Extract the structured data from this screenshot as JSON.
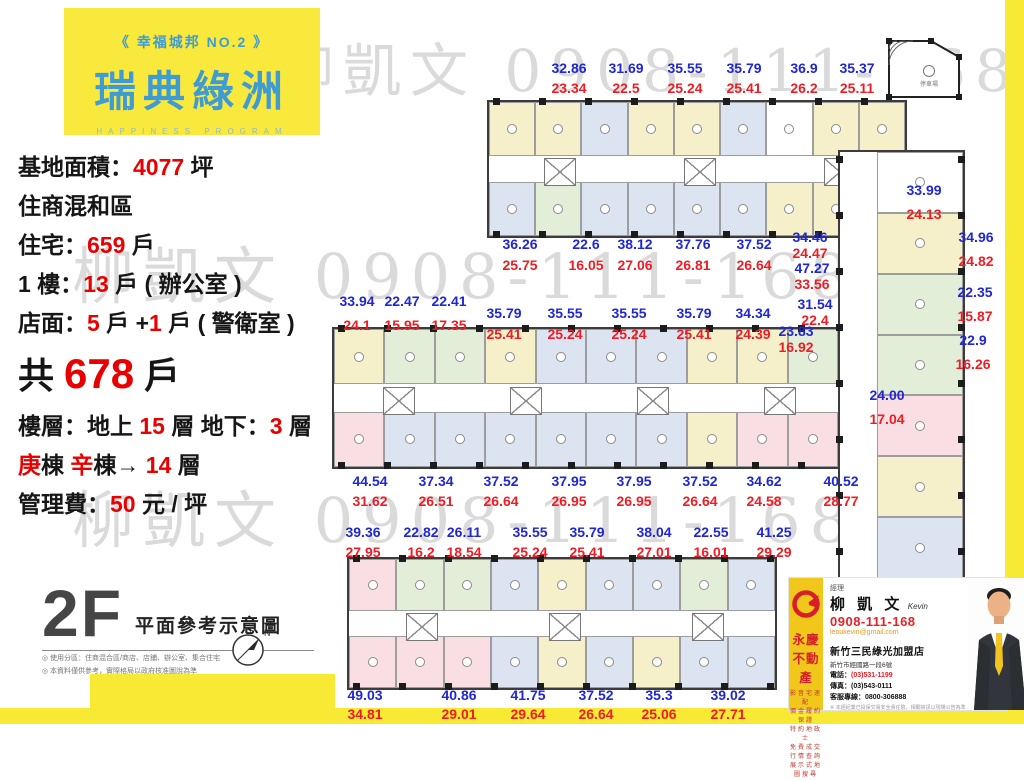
{
  "logo": {
    "tagline": "《 幸福城邦 NO.2 》",
    "title": "瑞典綠洲",
    "subtitle": "HAPPINESS PROGRAM"
  },
  "info": {
    "lines": [
      {
        "segs": [
          [
            "基地面積：",
            "k"
          ],
          [
            "4077",
            "r"
          ],
          [
            " 坪",
            "k"
          ]
        ]
      },
      {
        "segs": [
          [
            "住商混和區",
            "k"
          ]
        ]
      },
      {
        "segs": [
          [
            "住宅：",
            "k"
          ],
          [
            "659",
            "r"
          ],
          [
            " 戶",
            "k"
          ]
        ]
      },
      {
        "segs": [
          [
            "1 樓：",
            "k"
          ],
          [
            "13",
            "r"
          ],
          [
            " 戶 ( 辦公室 )",
            "k"
          ]
        ]
      },
      {
        "segs": [
          [
            "店面：",
            "k"
          ],
          [
            "5",
            "r"
          ],
          [
            " 戶 +",
            "k"
          ],
          [
            "1",
            "r"
          ],
          [
            " 戶 ( 警衛室 )",
            "k"
          ]
        ]
      },
      {
        "big": true,
        "segs": [
          [
            "共 ",
            "k"
          ],
          [
            "678",
            "r"
          ],
          [
            " 戶",
            "k"
          ]
        ]
      },
      {
        "segs": [
          [
            "樓層：地上 ",
            "k"
          ],
          [
            "15",
            "r"
          ],
          [
            " 層 地下：",
            "k"
          ],
          [
            "3",
            "r"
          ],
          [
            " 層",
            "k"
          ]
        ]
      },
      {
        "segs": [
          [
            "庚",
            "r"
          ],
          [
            "棟  ",
            "k"
          ],
          [
            "辛",
            "r"
          ],
          [
            "棟→ ",
            "k"
          ],
          [
            "14",
            "r"
          ],
          [
            " 層",
            "k"
          ]
        ]
      },
      {
        "segs": [
          [
            "管理費：",
            "k"
          ],
          [
            "50",
            "r"
          ],
          [
            " 元 / 坪",
            "k"
          ]
        ]
      }
    ]
  },
  "floor_label": {
    "big": "2F",
    "name": "平面參考示意圖",
    "compass_n": "N",
    "notes": [
      "◎ 使用分區：住商混合區/商店、店鋪、辦公室、集合住宅",
      "◎ 本資料僅供參考，實際格局以政府核准圖說為準"
    ]
  },
  "watermark": {
    "text": "柳凱文 0908-111-168",
    "rows": [
      {
        "x": 276,
        "y": 24,
        "size": 58
      },
      {
        "x": 72,
        "y": 226,
        "size": 62
      },
      {
        "x": 72,
        "y": 470,
        "size": 62
      }
    ]
  },
  "parking": {
    "label": "停車場"
  },
  "palette": {
    "y": "#f5efca",
    "g": "#e3eed9",
    "b": "#dde4f1",
    "p": "#f9dfe4",
    "w": "#ffffff"
  },
  "plans": [
    {
      "x": 487,
      "y": 100,
      "w": 420,
      "h": 138,
      "o": "h",
      "top": [
        "y",
        "y",
        "b",
        "y",
        "y",
        "b",
        "w",
        "y",
        "y"
      ],
      "bot": [
        "b",
        "g",
        "b",
        "b",
        "b",
        "b",
        "y",
        "y",
        "w"
      ],
      "cores": 3
    },
    {
      "x": 332,
      "y": 327,
      "w": 508,
      "h": 142,
      "o": "h",
      "top": [
        "y",
        "g",
        "g",
        "y",
        "b",
        "b",
        "b",
        "y",
        "y",
        "g"
      ],
      "bot": [
        "p",
        "b",
        "b",
        "b",
        "b",
        "b",
        "b",
        "y",
        "p",
        "p"
      ],
      "cores": 4
    },
    {
      "x": 838,
      "y": 150,
      "w": 127,
      "h": 430,
      "o": "v",
      "units": [
        "w",
        "y",
        "g",
        "g",
        "p",
        "y",
        "b"
      ]
    },
    {
      "x": 347,
      "y": 557,
      "w": 430,
      "h": 133,
      "o": "h",
      "top": [
        "p",
        "g",
        "g",
        "b",
        "y",
        "b",
        "b",
        "g",
        "b"
      ],
      "bot": [
        "p",
        "p",
        "p",
        "b",
        "y",
        "b",
        "y",
        "b",
        "b"
      ],
      "cores": 3
    }
  ],
  "pairs": [
    [
      569,
      61,
      "32.86",
      "23.34",
      5
    ],
    [
      626,
      61,
      "31.69",
      "22.5",
      5
    ],
    [
      685,
      61,
      "35.55",
      "25.24",
      5
    ],
    [
      744,
      61,
      "35.79",
      "25.41",
      5
    ],
    [
      804,
      61,
      "36.9",
      "26.2",
      5
    ],
    [
      857,
      61,
      "35.37",
      "25.11",
      5
    ],
    [
      520,
      237,
      "36.26",
      "25.75",
      6
    ],
    [
      586,
      237,
      "22.6",
      "16.05",
      6
    ],
    [
      635,
      237,
      "38.12",
      "27.06",
      6
    ],
    [
      693,
      237,
      "37.76",
      "26.81",
      6
    ],
    [
      754,
      237,
      "37.52",
      "26.64",
      6
    ],
    [
      810,
      230,
      "34.46",
      "24.47",
      1
    ],
    [
      812,
      261,
      "47.27",
      "33.56",
      1
    ],
    [
      357,
      294,
      "33.94",
      "24.1",
      9
    ],
    [
      402,
      294,
      "22.47",
      "15.95",
      9
    ],
    [
      449,
      294,
      "22.41",
      "17.35",
      9
    ],
    [
      504,
      306,
      "35.79",
      "25.41",
      6
    ],
    [
      565,
      306,
      "35.55",
      "25.24",
      6
    ],
    [
      629,
      306,
      "35.55",
      "25.24",
      6
    ],
    [
      694,
      306,
      "35.79",
      "25.41",
      6
    ],
    [
      753,
      306,
      "34.34",
      "24.39",
      6
    ],
    [
      815,
      297,
      "31.54",
      "22.4",
      1
    ],
    [
      796,
      324,
      "23.83",
      "16.92",
      1
    ],
    [
      924,
      183,
      "33.99",
      "24.13",
      9
    ],
    [
      976,
      230,
      "34.96",
      "24.82",
      9
    ],
    [
      975,
      285,
      "22.35",
      "15.87",
      9
    ],
    [
      973,
      333,
      "22.9",
      "16.26",
      9
    ],
    [
      887,
      388,
      "24.00",
      "17.04",
      9
    ],
    [
      370,
      474,
      "44.54",
      "31.62",
      5
    ],
    [
      436,
      474,
      "37.34",
      "26.51",
      5
    ],
    [
      501,
      474,
      "37.52",
      "26.64",
      5
    ],
    [
      569,
      474,
      "37.95",
      "26.95",
      5
    ],
    [
      634,
      474,
      "37.95",
      "26.95",
      5
    ],
    [
      700,
      474,
      "37.52",
      "26.64",
      5
    ],
    [
      764,
      474,
      "34.62",
      "24.58",
      5
    ],
    [
      841,
      474,
      "40.52",
      "28.77",
      5
    ],
    [
      363,
      525,
      "39.36",
      "27.95",
      5
    ],
    [
      421,
      525,
      "22.82",
      "16.2",
      5
    ],
    [
      464,
      525,
      "26.11",
      "18.54",
      5
    ],
    [
      530,
      525,
      "35.55",
      "25.24",
      5
    ],
    [
      587,
      525,
      "35.79",
      "25.41",
      5
    ],
    [
      654,
      525,
      "38.04",
      "27.01",
      5
    ],
    [
      711,
      525,
      "22.55",
      "16.01",
      5
    ],
    [
      774,
      525,
      "41.25",
      "29.29",
      5
    ],
    [
      365,
      688,
      "49.03",
      "34.81",
      4
    ],
    [
      459,
      688,
      "40.86",
      "29.01",
      4
    ],
    [
      528,
      688,
      "41.75",
      "29.64",
      4
    ],
    [
      596,
      688,
      "37.52",
      "26.64",
      4
    ],
    [
      659,
      688,
      "35.3",
      "25.06",
      4
    ],
    [
      728,
      688,
      "39.02",
      "27.71",
      4
    ]
  ],
  "card": {
    "brand": "永慶不動產",
    "features": [
      "影音宅速配",
      "價金履約保證",
      "特約地政士",
      "免費成交行情查詢",
      "展示式地圖搜尋"
    ],
    "manager_title": "經理",
    "name": "柳 凱 文",
    "name_en": "Kevin",
    "phone": "0908-111-168",
    "email": "leoukevin@gmail.com",
    "store": "新竹三民綠光加盟店",
    "address": "新竹市經國路一段6號",
    "tel_label": "電話：",
    "tel": "(03)531-1199",
    "fax_label": "傳真：",
    "fax": "(03)543-0111",
    "hotline_label": "客服專線：",
    "hotline": "0800-306888",
    "fineprint": "※ 本經紀業已投保交易安全責任險，相關資訊以現場公告為準"
  }
}
